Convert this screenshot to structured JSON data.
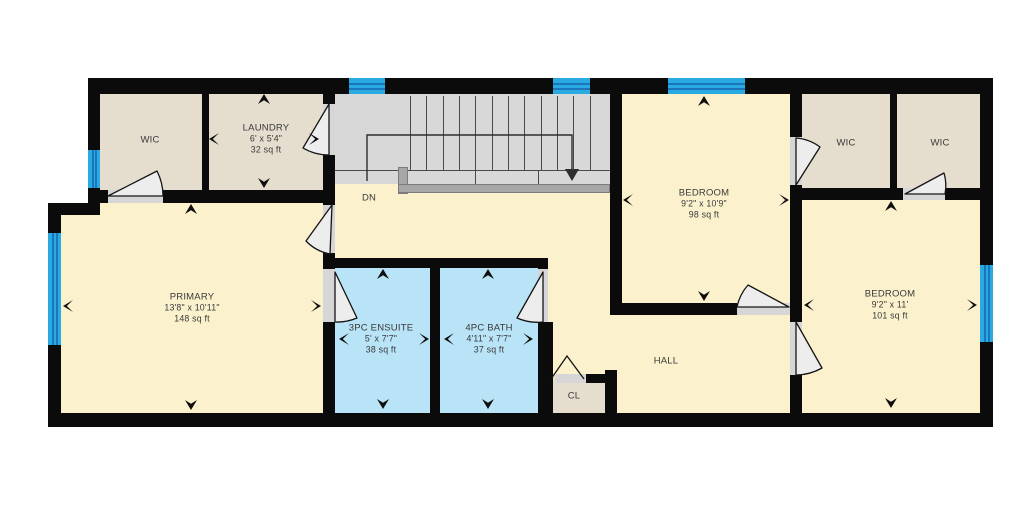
{
  "plan": {
    "colors": {
      "wall": "#0b0b0b",
      "cream": "#fbf1cd",
      "beige": "#e5ddce",
      "blue": "#b9e3f6",
      "stair_gray": "#d8d8d8",
      "railing_gray": "#a7a7a7",
      "window_cyan": "#29abe2",
      "window_line": "#1b75bc",
      "threshold": "#d6d6d6",
      "door_fill": "#ededed",
      "door_stroke": "#141414",
      "text": "#3a3a3a"
    },
    "rooms": [
      {
        "name": "stairwell",
        "label": "",
        "rect": [
          335,
          94,
          275,
          90
        ],
        "fill": "stair_gray"
      },
      {
        "name": "hall-landing",
        "label": "",
        "rect": [
          335,
          184,
          275,
          74
        ],
        "fill": "cream"
      },
      {
        "name": "hall-corridor",
        "label": "",
        "rect": [
          548,
          258,
          62,
          155
        ],
        "fill": "cream"
      },
      {
        "name": "hall-main",
        "label": "HALL",
        "rect": [
          610,
          315,
          180,
          98
        ],
        "fill": "cream",
        "label_xy": [
          666,
          361
        ]
      },
      {
        "name": "wic-top-left",
        "label": "WIC",
        "rect": [
          100,
          94,
          102,
          96
        ],
        "fill": "beige",
        "label_xy": [
          150,
          140
        ]
      },
      {
        "name": "laundry",
        "label": "LAUNDRY",
        "dims": "6' x 5'4\"",
        "area": "32 sq ft",
        "rect": [
          209,
          94,
          114,
          96
        ],
        "fill": "beige",
        "label_xy": [
          266,
          139
        ]
      },
      {
        "name": "bedroom-top",
        "label": "BEDROOM",
        "dims": "9'2\" x 10'9\"",
        "area": "98 sq ft",
        "rect": [
          622,
          94,
          168,
          209
        ],
        "fill": "cream",
        "label_xy": [
          704,
          204
        ]
      },
      {
        "name": "wic-right-1",
        "label": "WIC",
        "rect": [
          802,
          94,
          88,
          94
        ],
        "fill": "beige",
        "label_xy": [
          846,
          143
        ]
      },
      {
        "name": "wic-right-2",
        "label": "WIC",
        "rect": [
          897,
          94,
          83,
          94
        ],
        "fill": "beige",
        "label_xy": [
          940,
          143
        ]
      },
      {
        "name": "primary",
        "label": "PRIMARY",
        "dims": "13'8\" x 10'11\"",
        "area": "148 sq ft",
        "rect": [
          100,
          203,
          223,
          210
        ],
        "fill": "cream",
        "label_xy": [
          192,
          308
        ]
      },
      {
        "name": "primary-west",
        "label": "",
        "rect": [
          60,
          215,
          45,
          198
        ],
        "fill": "cream"
      },
      {
        "name": "ensuite",
        "label": "3PC ENSUITE",
        "dims": "5' x 7'7\"",
        "area": "38 sq ft",
        "rect": [
          335,
          268,
          95,
          145
        ],
        "fill": "blue",
        "label_xy": [
          381,
          339
        ]
      },
      {
        "name": "bath",
        "label": "4PC BATH",
        "dims": "4'11\" x 7'7\"",
        "area": "37 sq ft",
        "rect": [
          440,
          268,
          98,
          145
        ],
        "fill": "blue",
        "label_xy": [
          489,
          339
        ]
      },
      {
        "name": "closet",
        "label": "CL",
        "rect": [
          548,
          375,
          57,
          38
        ],
        "fill": "beige",
        "label_xy": [
          574,
          396
        ]
      },
      {
        "name": "bedroom-right",
        "label": "BEDROOM",
        "dims": "9'2\" x 11'",
        "area": "101 sq ft",
        "rect": [
          802,
          200,
          178,
          213
        ],
        "fill": "cream",
        "label_xy": [
          890,
          305
        ]
      }
    ],
    "annotations": [
      {
        "name": "stairs-direction",
        "label": "DN",
        "xy": [
          369,
          198
        ]
      }
    ],
    "walls": [
      [
        88,
        78,
        905,
        16
      ],
      [
        980,
        78,
        13,
        348
      ],
      [
        48,
        413,
        945,
        14
      ],
      [
        48,
        203,
        13,
        210
      ],
      [
        88,
        78,
        12,
        125
      ],
      [
        48,
        203,
        52,
        12
      ],
      [
        202,
        94,
        7,
        96
      ],
      [
        323,
        94,
        12,
        10
      ],
      [
        323,
        155,
        12,
        50
      ],
      [
        88,
        190,
        20,
        13
      ],
      [
        163,
        190,
        172,
        13
      ],
      [
        323,
        253,
        12,
        16
      ],
      [
        323,
        322,
        12,
        91
      ],
      [
        335,
        258,
        203,
        10
      ],
      [
        430,
        258,
        10,
        155
      ],
      [
        538,
        258,
        10,
        11
      ],
      [
        538,
        322,
        15,
        91
      ],
      [
        586,
        374,
        19,
        9
      ],
      [
        605,
        370,
        12,
        43
      ],
      [
        610,
        94,
        12,
        221
      ],
      [
        610,
        303,
        127,
        12
      ],
      [
        790,
        94,
        12,
        43
      ],
      [
        790,
        185,
        12,
        137
      ],
      [
        790,
        375,
        12,
        38
      ],
      [
        890,
        94,
        7,
        94
      ],
      [
        790,
        188,
        113,
        12
      ],
      [
        945,
        188,
        35,
        12
      ]
    ],
    "thresholds": [
      [
        323,
        104,
        12,
        51
      ],
      [
        108,
        190,
        55,
        13
      ],
      [
        323,
        205,
        12,
        48
      ],
      [
        323,
        269,
        12,
        53
      ],
      [
        538,
        269,
        10,
        53
      ],
      [
        737,
        303,
        53,
        12
      ],
      [
        790,
        137,
        12,
        48
      ],
      [
        790,
        322,
        12,
        53
      ],
      [
        903,
        188,
        42,
        12
      ],
      [
        556,
        374,
        30,
        9
      ]
    ],
    "windows": [
      {
        "rect": [
          88,
          150,
          12,
          38
        ],
        "orient": "v"
      },
      {
        "rect": [
          48,
          233,
          13,
          112
        ],
        "orient": "v"
      },
      {
        "rect": [
          349,
          78,
          36,
          16
        ],
        "orient": "h"
      },
      {
        "rect": [
          553,
          78,
          37,
          16
        ],
        "orient": "h"
      },
      {
        "rect": [
          668,
          78,
          77,
          16
        ],
        "orient": "h"
      },
      {
        "rect": [
          980,
          265,
          13,
          77
        ],
        "orient": "v"
      }
    ],
    "stairs": {
      "risers_upper_x": [
        410,
        426,
        443,
        459,
        475,
        492,
        508,
        524,
        541,
        557,
        573,
        590
      ],
      "riser_top_y": 96,
      "riser_upper_h": 74,
      "hline": [
        335,
        170,
        275,
        1
      ],
      "risers_lower": [
        {
          "x": 475,
          "y": 170,
          "h": 14
        },
        {
          "x": 538,
          "y": 170,
          "h": 14
        }
      ],
      "railing": [
        [
          398,
          167,
          10,
          27
        ],
        [
          398,
          184,
          212,
          9
        ]
      ],
      "guide_path": "M367,181 L367,135 L572,135 L572,170",
      "guide_arrow_points": "565,169 579,169 572,181"
    },
    "doors": [
      {
        "name": "door-wic-top-left",
        "path": "M108,196 L157,171 A55,55 0 0 1 163,196 Z"
      },
      {
        "name": "door-laundry",
        "path": "M329,104 L303,148 A51,51 0 0 0 329,155 Z"
      },
      {
        "name": "door-primary",
        "path": "M332,205 L306,241 A45,45 0 0 0 330,254 Z"
      },
      {
        "name": "door-ensuite",
        "path": "M335,272 L357,318 A51,51 0 0 1 335,322 Z"
      },
      {
        "name": "door-bath",
        "path": "M543,272 L517,318 A51,51 0 0 0 543,322 Z"
      },
      {
        "name": "door-bedroom-top",
        "path": "M789,307 L748,285 A47,47 0 0 0 737,307 Z"
      },
      {
        "name": "door-bedroom-right",
        "path": "M796,322 L822,368 A53,53 0 0 1 796,375 Z"
      },
      {
        "name": "door-wic-right-1",
        "path": "M796,185 L820,147 A46,46 0 0 0 796,138 Z"
      },
      {
        "name": "door-wic-right-2",
        "path": "M905,194 L944,173 A44,44 0 0 1 945,194 Z"
      }
    ],
    "closet_bifold_points": "551,379 567,356 584,379",
    "arrows": [
      {
        "d": "up",
        "x": 264,
        "y": 99
      },
      {
        "d": "left",
        "x": 214,
        "y": 139
      },
      {
        "d": "right",
        "x": 314,
        "y": 139
      },
      {
        "d": "down",
        "x": 264,
        "y": 183
      },
      {
        "d": "up",
        "x": 191,
        "y": 209
      },
      {
        "d": "left",
        "x": 68,
        "y": 306
      },
      {
        "d": "right",
        "x": 316,
        "y": 306
      },
      {
        "d": "down",
        "x": 191,
        "y": 405
      },
      {
        "d": "up",
        "x": 383,
        "y": 274
      },
      {
        "d": "left",
        "x": 344,
        "y": 339
      },
      {
        "d": "right",
        "x": 424,
        "y": 339
      },
      {
        "d": "down",
        "x": 383,
        "y": 404
      },
      {
        "d": "up",
        "x": 488,
        "y": 274
      },
      {
        "d": "left",
        "x": 449,
        "y": 339
      },
      {
        "d": "right",
        "x": 528,
        "y": 339
      },
      {
        "d": "down",
        "x": 488,
        "y": 404
      },
      {
        "d": "up",
        "x": 704,
        "y": 101
      },
      {
        "d": "left",
        "x": 628,
        "y": 200
      },
      {
        "d": "right",
        "x": 784,
        "y": 200
      },
      {
        "d": "down",
        "x": 704,
        "y": 296
      },
      {
        "d": "up",
        "x": 891,
        "y": 206
      },
      {
        "d": "left",
        "x": 809,
        "y": 305
      },
      {
        "d": "right",
        "x": 972,
        "y": 305
      },
      {
        "d": "down",
        "x": 891,
        "y": 403
      }
    ]
  }
}
